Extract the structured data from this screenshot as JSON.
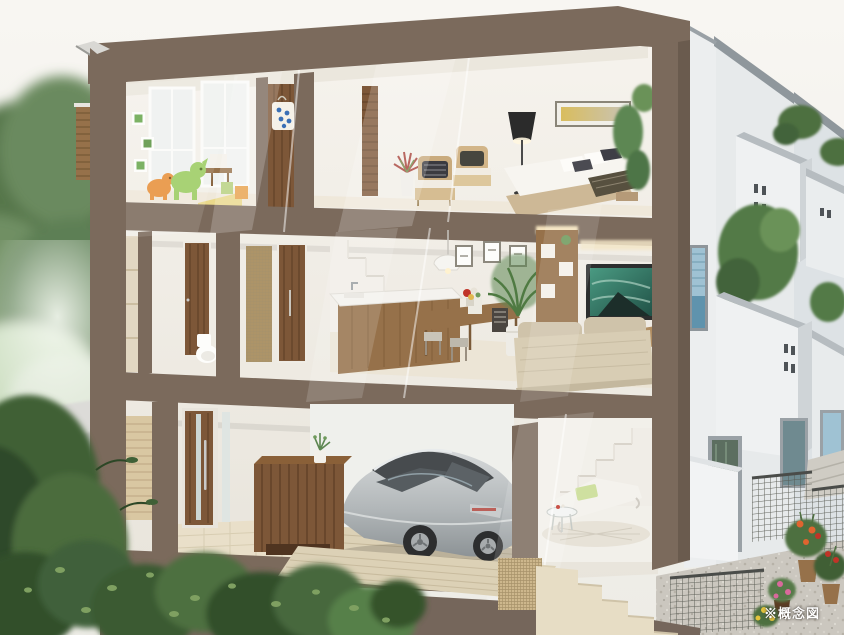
{
  "caption": {
    "note": "※概念図"
  },
  "colors": {
    "sky": "#f6f4f0",
    "frame": "#7b6a5c",
    "frameDark": "#6a5b4e",
    "frameDeep": "#75665b",
    "wall": "#f3f0ea",
    "wallShade": "#e6e2da",
    "wood": "#7d5738",
    "woodLight": "#96714a",
    "woodDark": "#5c3d24",
    "deck": "#dcd1b6",
    "tile": "#e9dfc9",
    "stone": "#d9c7a2",
    "exterior": "#e7eaeb",
    "exteriorShade": "#cfd4d7",
    "parapet": "#8f979c",
    "glass": "#9fc2d3",
    "glassDark": "#4a5054",
    "car": "#b5b9bb",
    "carDark": "#46494c",
    "tv": "#37806c",
    "sofa": "#d8cdb4",
    "leaf": "#4e7040",
    "leafDark": "#2f4a2a",
    "leafLight": "#7fa061",
    "lawn": "#cfe0c4",
    "gravel": "#cbc7bf",
    "concrete": "#c2c2c0",
    "concreteLight": "#dcdbd8",
    "toyGreen": "#9ccc62",
    "toyOrange": "#e8913c",
    "blockYellow": "#e9d88a",
    "bagBlue": "#3a6fb5",
    "lamp": "#2b2b2b",
    "flowerOrange": "#e0642f",
    "flowerRed": "#c03428",
    "flowerPink": "#d9699c",
    "flowerYellow": "#e3c43c"
  }
}
